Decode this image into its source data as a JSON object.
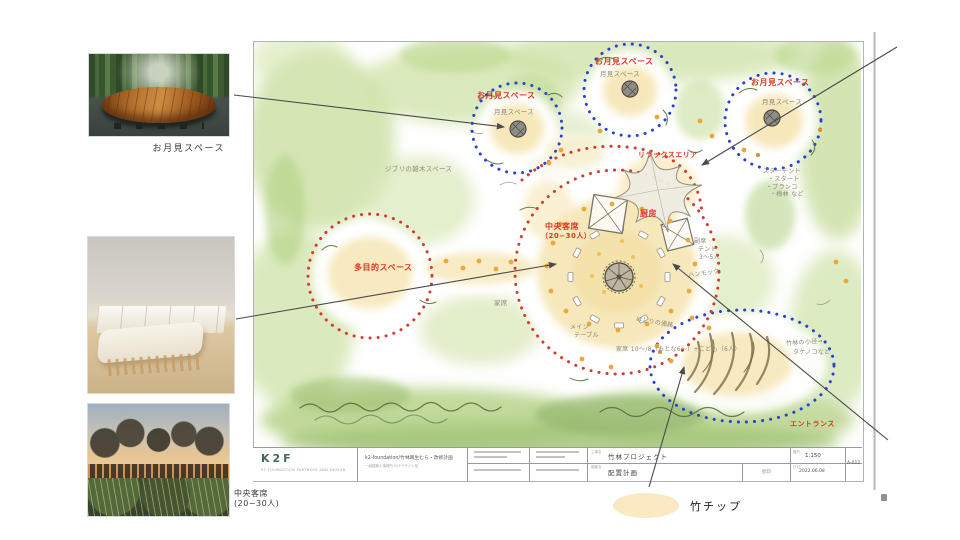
{
  "colors": {
    "label_red": "#de3423",
    "dot_blue": "#2b3fd4",
    "dot_red": "#d43a2e",
    "watercolor_green": "#cbe0a2",
    "cream_patch": "#f6e6b5",
    "legend_cream": "#fbe9c4",
    "pencil_gray": "#8b8678",
    "logo_green": "#47695a"
  },
  "left_panel": {
    "photo1_caption": "お月見スペース",
    "photo3_caption_line1": "中央客席",
    "photo3_caption_line2": "(20−30人)"
  },
  "plan": {
    "labels": {
      "moon": "お月見スペース",
      "moon_hand": "月見スペース",
      "relax": "リラックスエリア",
      "central_line1": "中央客席",
      "central_line2": "（20−30人）",
      "kitchen": "厨房",
      "multi": "多目的スペース",
      "entrance": "エントランス"
    },
    "notes": {
      "zouki": "ジブリの雑木スペース",
      "star1": "スターテント",
      "star2": "・スタート",
      "star3": "・ブランコ",
      "star4": "・梅林 など",
      "side1": "副席",
      "side2": "テント",
      "side3": "3〜5人",
      "hammock": "ハンモック",
      "kaseki": "家席",
      "main1": "メイン",
      "main2": "テーブル",
      "count": "家席 10〜/8（おとな6〜）+こども（6人）",
      "hashiri": "はしりの通路",
      "bamboo1": "竹林の小径→",
      "bamboo2": "タケノコなど"
    }
  },
  "titleblock": {
    "logo": "K2F",
    "logo_sub": "K2 FOUNDATION PARTNERS AND DESIGN",
    "client_line1": "k2-foundation/竹林再生むら・改修計画",
    "client_line2": "一級建築士事務所 K2Fデザイン室",
    "label_project": "工事名",
    "project": "竹林プロジェクト",
    "label_drawing": "図面名",
    "drawing": "配置計画",
    "stamp": "捺印",
    "scale_label": "縮尺",
    "scale": "1:150",
    "date_label": "日付",
    "date": "2022.06.08",
    "dwg_no": "A-012"
  },
  "legend": {
    "bamboo_chips": "竹チップ"
  }
}
